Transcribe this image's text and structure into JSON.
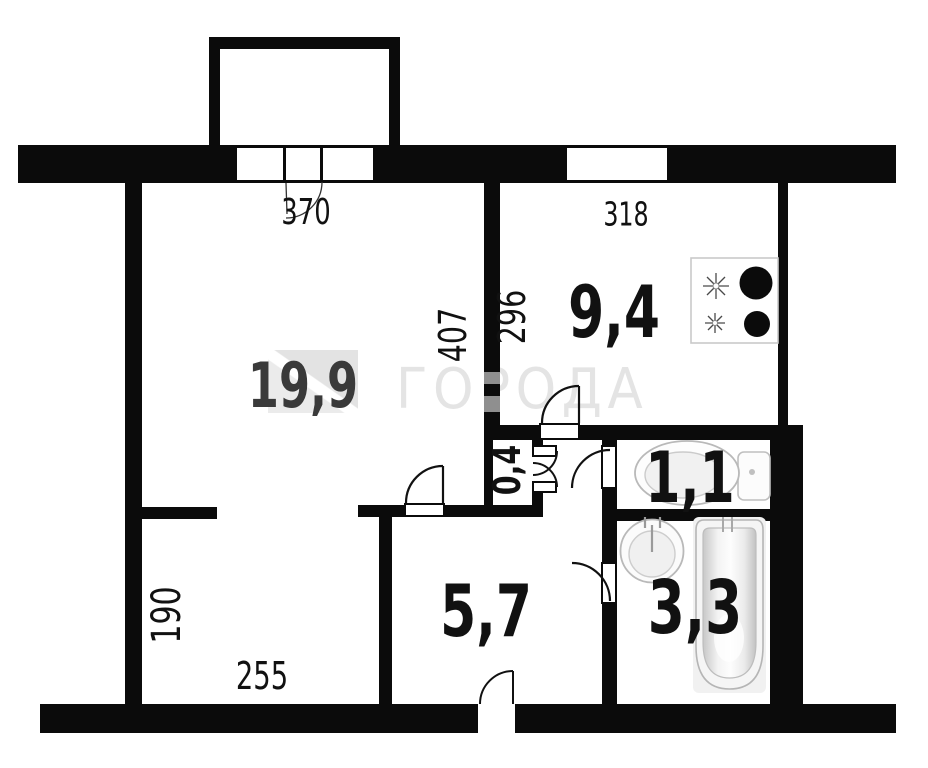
{
  "watermark": {
    "text": "ГОРОДА"
  },
  "rooms": {
    "living": {
      "area": "19,9"
    },
    "kitchen": {
      "area": "9,4"
    },
    "toilet": {
      "area": "1,1"
    },
    "bathroom": {
      "area": "3,3"
    },
    "hallway": {
      "area": "5,7"
    },
    "closet": {
      "area": "0,4"
    }
  },
  "dims": {
    "living_width": "370",
    "kitchen_width": "318",
    "kitchen_depth": "296",
    "living_depth": "407",
    "alcove_depth": "190",
    "alcove_width": "255"
  },
  "colors": {
    "wall": "#0b0b0b",
    "watermark": "#e4e4e4",
    "label": "#111111",
    "living_label": "#3a3a3a"
  }
}
